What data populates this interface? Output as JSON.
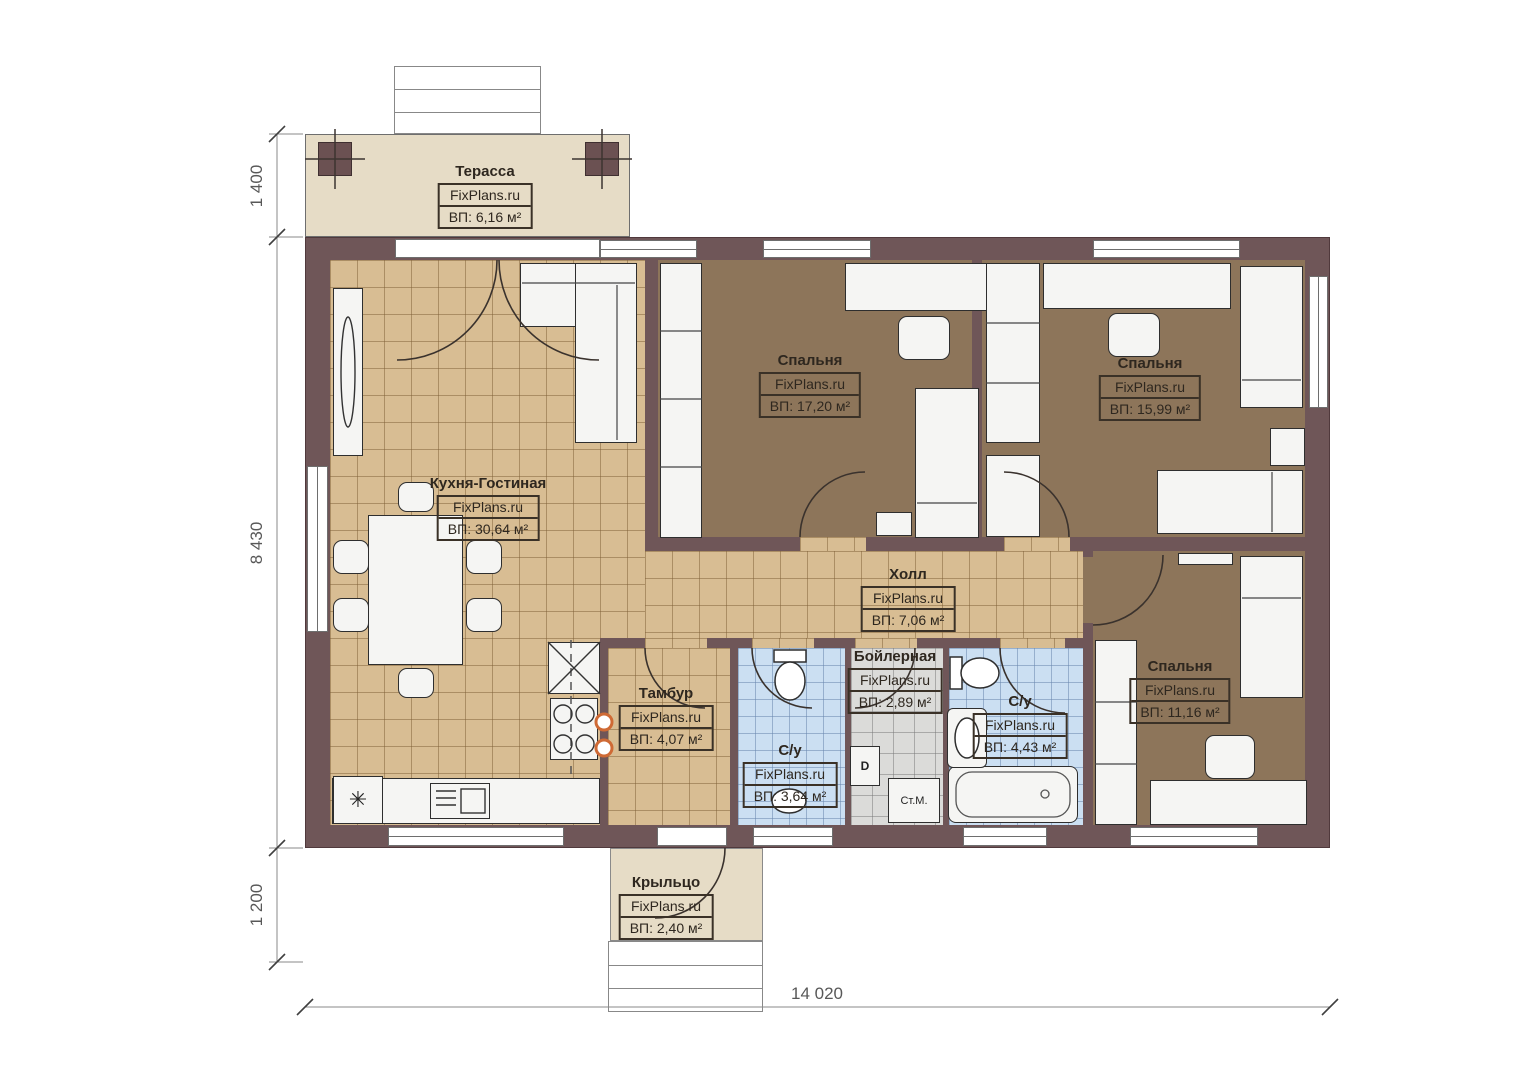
{
  "watermark": "FixPlans.ru",
  "rooms": {
    "terrace": {
      "name": "Терасса",
      "area": "ВП: 6,16 м²"
    },
    "kitchen_living": {
      "name": "Кухня-Гостиная",
      "area": "ВП: 30,64 м²"
    },
    "bedroom_1": {
      "name": "Спальня",
      "area": "ВП: 17,20 м²"
    },
    "bedroom_2": {
      "name": "Спальня",
      "area": "ВП: 15,99 м²"
    },
    "hall": {
      "name": "Холл",
      "area": "ВП: 7,06 м²"
    },
    "vestibule": {
      "name": "Тамбур",
      "area": "ВП: 4,07 м²"
    },
    "bathroom_small": {
      "name": "С/у",
      "area": "ВП: 3,64 м²"
    },
    "boiler_room": {
      "name": "Бойлерная",
      "area": "ВП: 2,89 м²"
    },
    "bathroom_large": {
      "name": "С/у",
      "area": "ВП: 4,43 м²"
    },
    "bedroom_3": {
      "name": "Спальня",
      "area": "ВП: 11,16 м²"
    },
    "porch": {
      "name": "Крыльцо",
      "area": "ВП: 2,40 м²"
    }
  },
  "dimensions": {
    "terrace_depth": "1 400",
    "house_depth": "8 430",
    "porch_depth": "1 200",
    "total_width": "14 020"
  },
  "equipment": {
    "washing_machine": "Ст.М.",
    "boiler": "D"
  },
  "icons": {
    "fridge_snowflake": "✳"
  },
  "colors": {
    "wall": "#6f5658",
    "tile_tan": "#d8bd93",
    "floor_brown": "#8d755a",
    "tile_blue": "#cbdff2",
    "tile_gray": "#dbdbd9",
    "floor_beige": "#e6dcc6"
  }
}
